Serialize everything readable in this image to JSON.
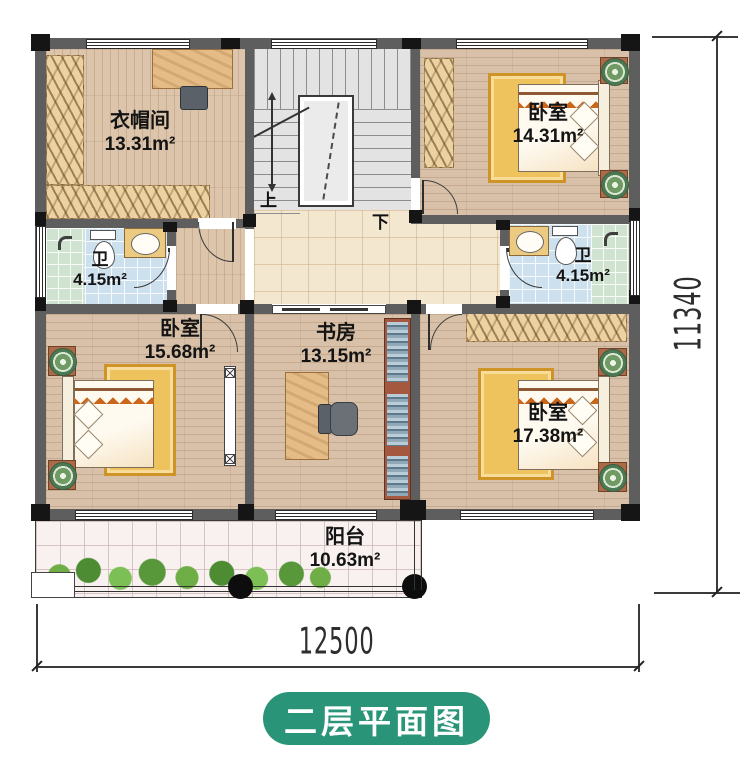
{
  "title": {
    "floor_plan_badge": "二层平面图"
  },
  "dimensions": {
    "bottom_width": "12500",
    "right_height": "11340"
  },
  "stairs": {
    "up": "上",
    "down": "下"
  },
  "rooms": {
    "cloakroom": {
      "name": "衣帽间",
      "area": "13.31m²"
    },
    "bedroom_ne": {
      "name": "卧室",
      "area": "14.31m²"
    },
    "bath_w": {
      "name": "卫",
      "area": "4.15m²"
    },
    "bath_e": {
      "name": "卫",
      "area": "4.15m²"
    },
    "bedroom_w": {
      "name": "卧室",
      "area": "15.68m²"
    },
    "study": {
      "name": "书房",
      "area": "13.15m²"
    },
    "bedroom_se": {
      "name": "卧室",
      "area": "17.38m²"
    },
    "balcony": {
      "name": "阳台",
      "area": "10.63m²"
    }
  },
  "colors": {
    "badge_green": "#2a9478",
    "wall_gray": "#5e5e5e"
  }
}
